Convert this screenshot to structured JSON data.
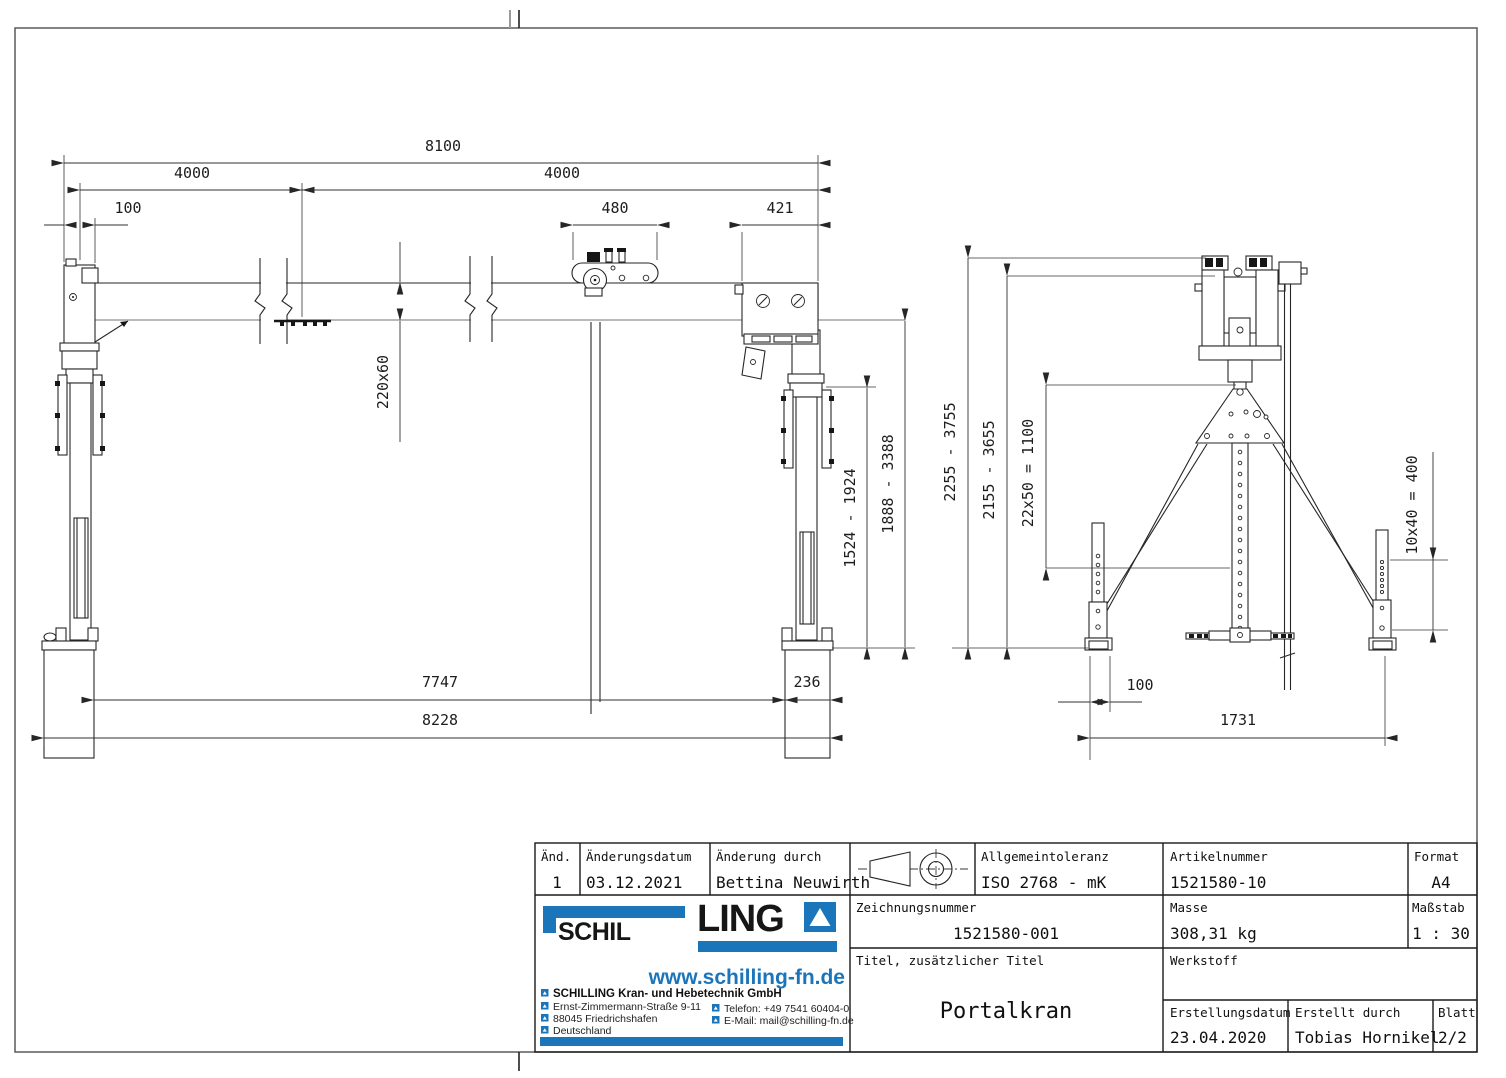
{
  "front_view": {
    "dim_span_total": "8100",
    "dim_span_left": "4000",
    "dim_span_right": "4000",
    "dim_offset_left": "100",
    "dim_trolley_width": "480",
    "dim_hoist_width": "421",
    "dim_beam_profile": "220x60",
    "dim_leg_stroke": "1524 - 1924",
    "dim_clearance": "1888 - 3388",
    "dim_inner_span": "7747",
    "dim_foot_width": "236",
    "dim_outer_span": "8228"
  },
  "side_view": {
    "dim_height_range": "2255 - 3755",
    "dim_hook_range": "2155 - 3655",
    "dim_hole_pattern_column": "22x50 = 1100",
    "dim_hole_pattern_leg": "10x40 = 400",
    "dim_foot_offset": "100",
    "dim_base_width": "1731"
  },
  "title_block": {
    "revision": {
      "label": "Änd.",
      "value": "1"
    },
    "revision_date": {
      "label": "Änderungsdatum",
      "value": "03.12.2021"
    },
    "revision_by": {
      "label": "Änderung durch",
      "value": "Bettina Neuwirth"
    },
    "tolerance": {
      "label": "Allgemeintoleranz",
      "value": "ISO 2768 - mK"
    },
    "article_number": {
      "label": "Artikelnummer",
      "value": "1521580-10"
    },
    "format": {
      "label": "Format",
      "value": "A4"
    },
    "drawing_number": {
      "label": "Zeichnungsnummer",
      "value": "1521580-001"
    },
    "mass": {
      "label": "Masse",
      "value": "308,31 kg"
    },
    "scale": {
      "label": "Maßstab",
      "value": "1 : 30"
    },
    "title": {
      "label": "Titel, zusätzlicher Titel",
      "value": "Portalkran"
    },
    "material": {
      "label": "Werkstoff",
      "value": ""
    },
    "creation_date": {
      "label": "Erstellungsdatum",
      "value": "23.04.2020"
    },
    "created_by": {
      "label": "Erstellt durch",
      "value": "Tobias Hornikel"
    },
    "sheet": {
      "label": "Blatt",
      "value": "2/2"
    }
  },
  "logo": {
    "brand_left": "SCHIL",
    "brand_right": "LING",
    "website": "www.schilling-fn.de",
    "company": "SCHILLING Kran- und Hebetechnik GmbH",
    "address_street": "Ernst-Zimmermann-Straße 9-11",
    "address_city": "88045 Friedrichshafen",
    "address_country": "Deutschland",
    "phone": "Telefon: +49 7541 60404-0",
    "email": "E-Mail: mail@schilling-fn.de"
  },
  "colors": {
    "accent_blue": "#1b75bb",
    "line_black": "#262626",
    "line_gray": "#8f8f8f"
  }
}
